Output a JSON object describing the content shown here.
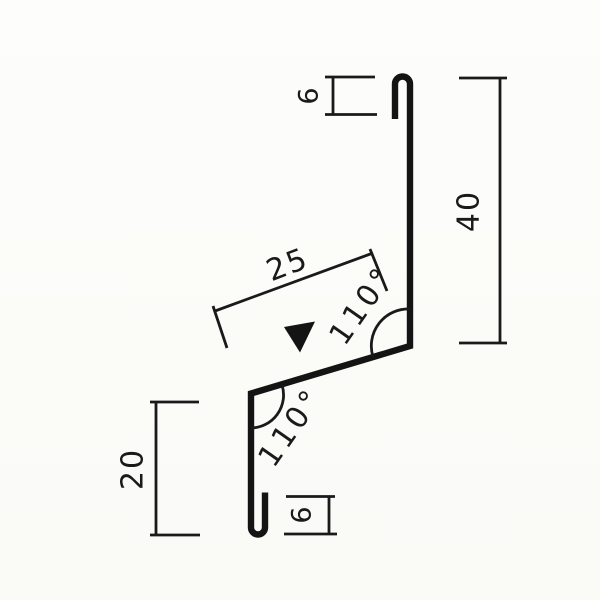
{
  "drawing": {
    "kind": "sheet-metal flashing profile cross-section",
    "colors": {
      "line": "#1a1a1a",
      "profile_line": "#141414",
      "background": "#fcfcfa",
      "marker_fill": "#141414"
    },
    "labels": {
      "top_hem": "6",
      "right_leg": "40",
      "slope": "25",
      "left_leg": "20",
      "bottom_hem": "6",
      "top_angle": "110°",
      "bottom_angle": "110°"
    },
    "marker": {
      "name": "direction-triangle",
      "description": "filled downward-pointing triangle on the slope face"
    }
  }
}
